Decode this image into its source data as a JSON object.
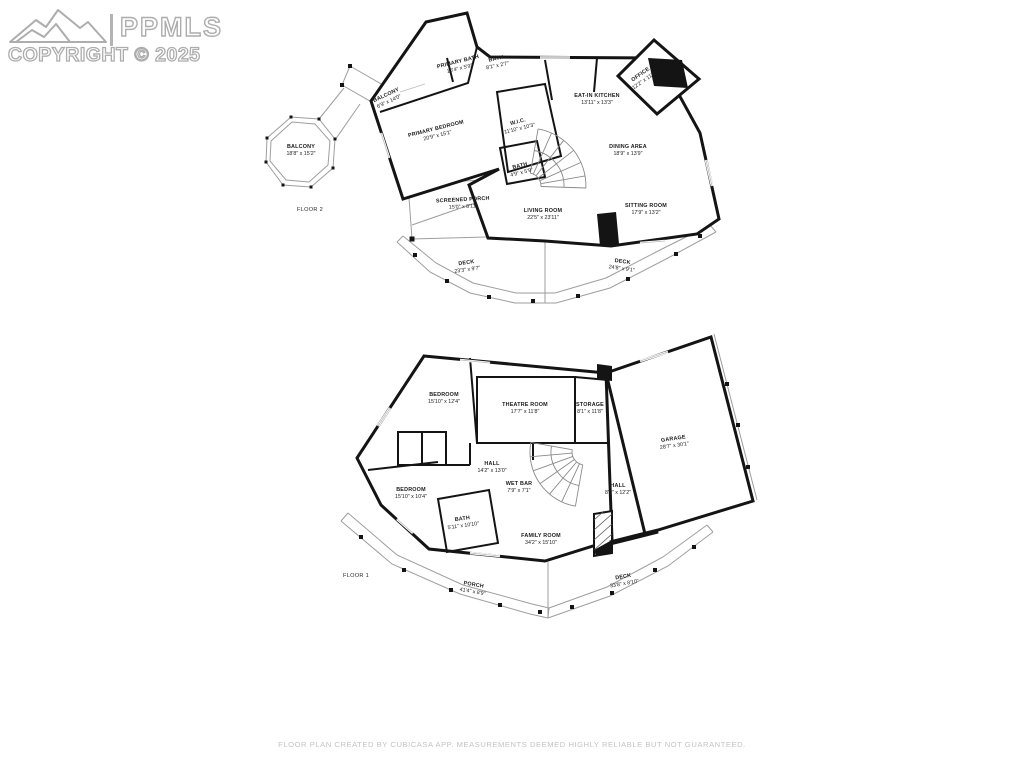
{
  "watermark": {
    "brand": "PPMLS",
    "copyright": "COPYRIGHT © 2025"
  },
  "footer": {
    "disclaimer": "FLOOR PLAN CREATED BY CUBICASA APP. MEASUREMENTS DEEMED HIGHLY RELIABLE BUT NOT GUARANTEED."
  },
  "floors": [
    {
      "name": "FLOOR 2",
      "name_pos": {
        "x": 310,
        "y": 210
      },
      "rooms": [
        {
          "label": "PRIMARY BATH",
          "dims": "10'4\" x 5'9\"",
          "x": 459,
          "y": 66,
          "rot": -14
        },
        {
          "label": "BATH",
          "dims": "8'1\" x 2'7\"",
          "x": 497,
          "y": 63,
          "rot": -12
        },
        {
          "label": "EAT-IN KITCHEN",
          "dims": "13'11\" x 13'3\"",
          "x": 597,
          "y": 100,
          "rot": 0
        },
        {
          "label": "OFFICE",
          "dims": "12'2\" x 11'9\"",
          "x": 643,
          "y": 78,
          "rot": -35
        },
        {
          "label": "W.I.C.",
          "dims": "11'10\" x 10'3\"",
          "x": 519,
          "y": 126,
          "rot": -14
        },
        {
          "label": "PRIMARY BEDROOM",
          "dims": "20'9\" x 15'1\"",
          "x": 437,
          "y": 133,
          "rot": -14
        },
        {
          "label": "BATH",
          "dims": "4'9\" x 5'9\"",
          "x": 521,
          "y": 170,
          "rot": -14
        },
        {
          "label": "DINING AREA",
          "dims": "18'9\" x 13'9\"",
          "x": 628,
          "y": 151,
          "rot": 0
        },
        {
          "label": "SITTING ROOM",
          "dims": "17'9\" x 13'2\"",
          "x": 646,
          "y": 210,
          "rot": 0
        },
        {
          "label": "SCREENED PORCH",
          "dims": "15'0\" x 8'11\"",
          "x": 463,
          "y": 204,
          "rot": -3
        },
        {
          "label": "LIVING ROOM",
          "dims": "22'5\" x 23'11\"",
          "x": 543,
          "y": 215,
          "rot": 0
        },
        {
          "label": "BALCONY",
          "dims": "6'9\" x 14'0\"",
          "x": 388,
          "y": 99,
          "rot": -25
        },
        {
          "label": "BALCONY",
          "dims": "18'8\" x 15'2\"",
          "x": 301,
          "y": 151,
          "rot": 0
        },
        {
          "label": "DECK",
          "dims": "23'3\" x 9'7\"",
          "x": 467,
          "y": 267,
          "rot": -8
        },
        {
          "label": "DECK",
          "dims": "24'8\" x 9'1\"",
          "x": 622,
          "y": 266,
          "rot": 8
        }
      ]
    },
    {
      "name": "FLOOR 1",
      "name_pos": {
        "x": 356,
        "y": 576
      },
      "rooms": [
        {
          "label": "BEDROOM",
          "dims": "15'10\" x 12'4\"",
          "x": 444,
          "y": 399,
          "rot": 0
        },
        {
          "label": "THEATRE ROOM",
          "dims": "17'7\" x 11'8\"",
          "x": 525,
          "y": 409,
          "rot": 0
        },
        {
          "label": "STORAGE",
          "dims": "8'1\" x 11'8\"",
          "x": 590,
          "y": 409,
          "rot": 0
        },
        {
          "label": "GARAGE",
          "dims": "28'7\" x 30'1\"",
          "x": 674,
          "y": 443,
          "rot": -8
        },
        {
          "label": "HALL",
          "dims": "14'2\" x 13'0\"",
          "x": 492,
          "y": 468,
          "rot": 0
        },
        {
          "label": "WET BAR",
          "dims": "7'9\" x 7'1\"",
          "x": 519,
          "y": 488,
          "rot": 0
        },
        {
          "label": "HALL",
          "dims": "8'0\" x 12'2\"",
          "x": 618,
          "y": 490,
          "rot": 0
        },
        {
          "label": "BEDROOM",
          "dims": "15'10\" x 10'4\"",
          "x": 411,
          "y": 494,
          "rot": 0
        },
        {
          "label": "BATH",
          "dims": "5'11\" x 10'10\"",
          "x": 463,
          "y": 523,
          "rot": -8
        },
        {
          "label": "FAMILY ROOM",
          "dims": "34'2\" x 15'10\"",
          "x": 541,
          "y": 540,
          "rot": 0
        },
        {
          "label": "PORCH",
          "dims": "41'4\" x 8'9\"",
          "x": 473,
          "y": 589,
          "rot": 10
        },
        {
          "label": "DECK",
          "dims": "33'8\" x 8'10\"",
          "x": 624,
          "y": 581,
          "rot": -10
        }
      ]
    }
  ]
}
